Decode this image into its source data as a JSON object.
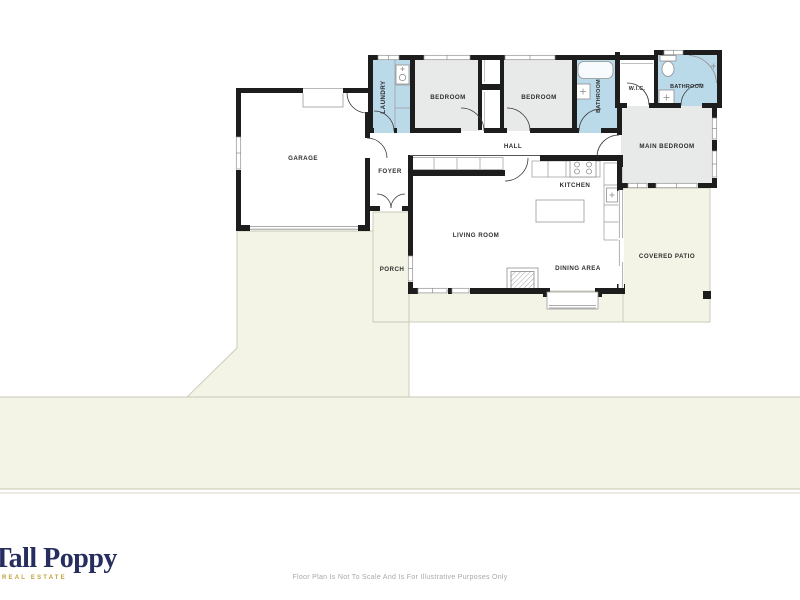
{
  "plan": {
    "rooms": {
      "garage": {
        "label": "GARAGE"
      },
      "laundry": {
        "label": "LAUNDRY"
      },
      "bedroom1": {
        "label": "BEDROOM"
      },
      "bedroom2": {
        "label": "BEDROOM"
      },
      "bathroom1": {
        "label": "BATHROOM"
      },
      "wic": {
        "label": "W.I.C."
      },
      "bathroom2": {
        "label": "BATHROOM"
      },
      "main_bedroom": {
        "label": "MAIN BEDROOM"
      },
      "hall": {
        "label": "HALL"
      },
      "foyer": {
        "label": "FOYER"
      },
      "kitchen": {
        "label": "KITCHEN"
      },
      "living_room": {
        "label": "LIVING ROOM"
      },
      "dining_area": {
        "label": "DINING AREA"
      },
      "porch": {
        "label": "PORCH"
      },
      "covered_patio": {
        "label": "COVERED PATIO"
      }
    }
  },
  "branding": {
    "logo_text": "Tall Poppy",
    "logo_tagline": "REAL ESTATE",
    "logo_color": "#252e5e",
    "tagline_color": "#bfa13a"
  },
  "footer": {
    "disclaimer": "Floor Plan Is Not To Scale And Is For Illustrative Purposes Only"
  },
  "palette": {
    "wall": "#1d1d1d",
    "bedroom_fill": "#e8e9e9",
    "wet_room_fill": "#bad9e9",
    "lot_fill": "#f4f4e6",
    "lot_line": "#c9c9b6",
    "label_text": "#2e2e2e"
  }
}
